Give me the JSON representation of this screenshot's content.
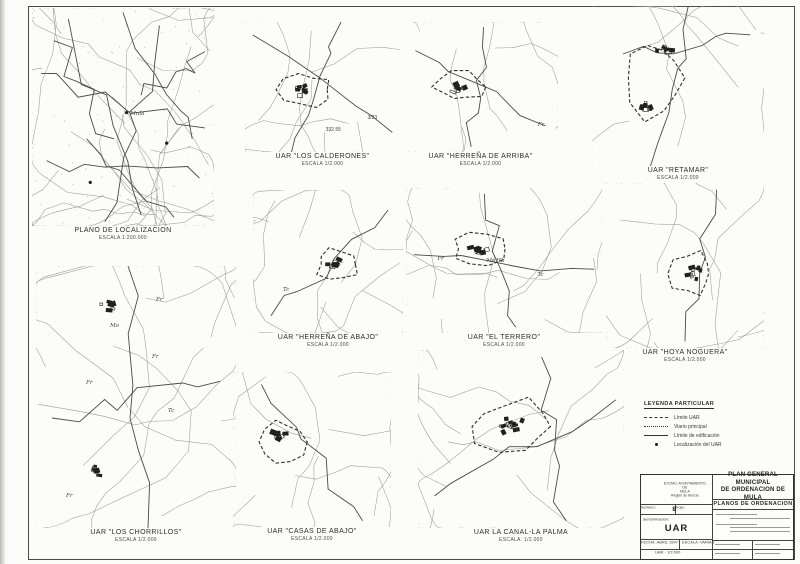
{
  "maps": [
    {
      "id": "localizacion",
      "title": "PLANO DE LOCALIZACION",
      "scale": "ESCALA 1:200.000",
      "annotations": [
        "Mula"
      ]
    },
    {
      "id": "los-calderones",
      "title": "UAR \"LOS CALDERONES\"",
      "scale": "ESCALA 1/2.000",
      "annotations": [
        "332.55",
        "3/23"
      ]
    },
    {
      "id": "herrena-de-arriba",
      "title": "UAR \"HERREÑA DE ARRIBA\"",
      "scale": "ESCALA 1/2.000",
      "annotations": [
        "Fr"
      ]
    },
    {
      "id": "retamar",
      "title": "UAR \"RETAMAR\"",
      "scale": "ESCALA 1/2.000",
      "annotations": []
    },
    {
      "id": "herrena-de-abajo",
      "title": "UAR \"HERREÑA DE ABAJO\"",
      "scale": "ESCALA 1/2.000",
      "annotations": [
        "Tc"
      ]
    },
    {
      "id": "el-terrero",
      "title": "UAR \"EL TERRERO\"",
      "scale": "ESCALA 1/2.000",
      "annotations": [
        "Fr",
        "Mo",
        "Hb",
        "Tc"
      ]
    },
    {
      "id": "hoya-noguera",
      "title": "UAR \"HOYA NOGUERA\"",
      "scale": "ESCALA 1/2.000",
      "annotations": []
    },
    {
      "id": "los-chorrillos",
      "title": "UAR \"LOS CHORRILLOS\"",
      "scale": "ESCALA 1/2.000",
      "annotations": [
        "Fr",
        "Mo",
        "Fr",
        "Fr",
        "Tc",
        "Fr"
      ]
    },
    {
      "id": "casas-de-abajo",
      "title": "UAR \"CASAS DE ABAJO\"",
      "scale": "ESCALA 1/2.000",
      "annotations": []
    },
    {
      "id": "la-canal-la-palma",
      "title": "UAR  LA CANAL-LA PALMA",
      "scale": "ESCALA: 1/2.000",
      "annotations": []
    }
  ],
  "legend": {
    "title": "LEYENDA PARTICULAR",
    "items": [
      {
        "symbol": "dashed-line",
        "label": "Límite UAR"
      },
      {
        "symbol": "dotted-line",
        "label": "Viario principal"
      },
      {
        "symbol": "solid-line",
        "label": "Límite de edificación"
      },
      {
        "symbol": "filled-dot",
        "label": "Localización del UAR"
      }
    ]
  },
  "title_block": {
    "org_line1": "EXCMO. AYUNTAMIENTO",
    "org_line2": "DE",
    "org_line3": "MULA",
    "org_line4": "Región de Murcia",
    "plan_title_line1": "PLAN GENERAL MUNICIPAL",
    "plan_title_line2": "DE ORDENACION DE MULA",
    "series": "PLANOS DE ORDENACION",
    "num_label": "número:",
    "num_value": "8",
    "hoja_label": "hoja:",
    "denom_label": "denominación:",
    "denom_value": "UAR",
    "fecha_label": "FECHA: ABRIL 1997",
    "escala_label": "ESCALA: VARIAS",
    "escala_detail": "UAR - 1/2.000"
  },
  "colors": {
    "line_dark": "#2f2f2f",
    "line_light": "#9b9b97",
    "paper": "#fcfcfa"
  }
}
